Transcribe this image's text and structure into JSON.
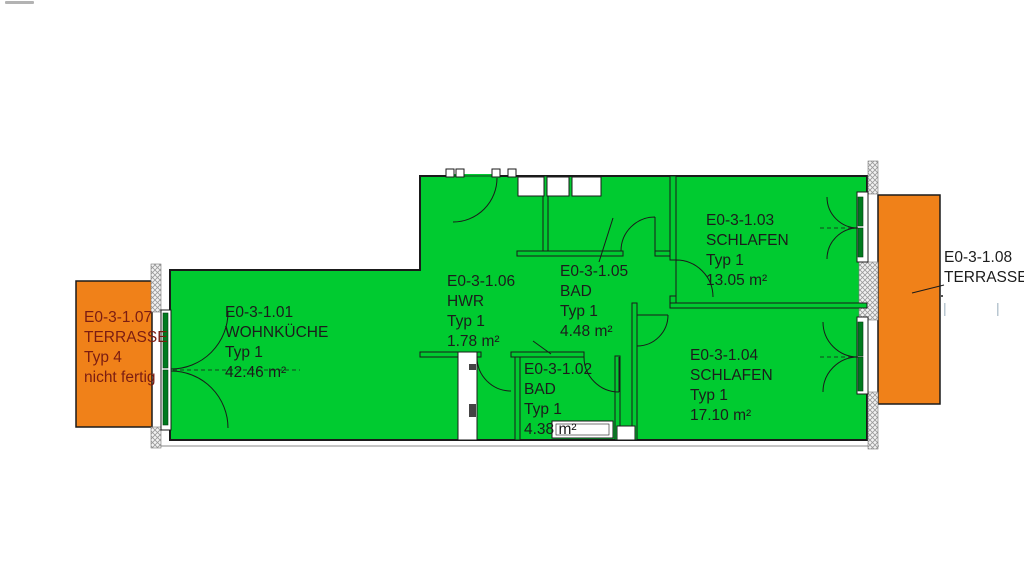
{
  "plan_type": "floor-plan",
  "colors": {
    "room_fill": "#00cb30",
    "door_leaf_fill": "#007a1e",
    "terrace_fill": "#f08119",
    "wall_line": "#1a1a1a",
    "room_label_color": "#1c1c1c",
    "terrace_left_label_color": "#7b1d12"
  },
  "rooms": {
    "r101": {
      "id": "E0-3-1.01",
      "name": "WOHNKÜCHE",
      "typ": "Typ 1",
      "area": "42.46 m²"
    },
    "r102": {
      "id": "E0-3-1.02",
      "name": "BAD",
      "typ": "Typ 1",
      "area": "4.38 m²"
    },
    "r103": {
      "id": "E0-3-1.03",
      "name": "SCHLAFEN",
      "typ": "Typ 1",
      "area": "13.05 m²"
    },
    "r104": {
      "id": "E0-3-1.04",
      "name": "SCHLAFEN",
      "typ": "Typ 1",
      "area": "17.10 m²"
    },
    "r105": {
      "id": "E0-3-1.05",
      "name": "BAD",
      "typ": "Typ 1",
      "area": "4.48 m²"
    },
    "r106": {
      "id": "E0-3-1.06",
      "name": "HWR",
      "typ": "Typ 1",
      "area": "1.78 m²"
    },
    "r107": {
      "id": "E0-3-1.07",
      "name": "TERRASSE",
      "typ": "Typ 4",
      "note": "nicht fertig"
    },
    "r108": {
      "id": "E0-3-1.08",
      "name": "TERRASSE"
    }
  }
}
